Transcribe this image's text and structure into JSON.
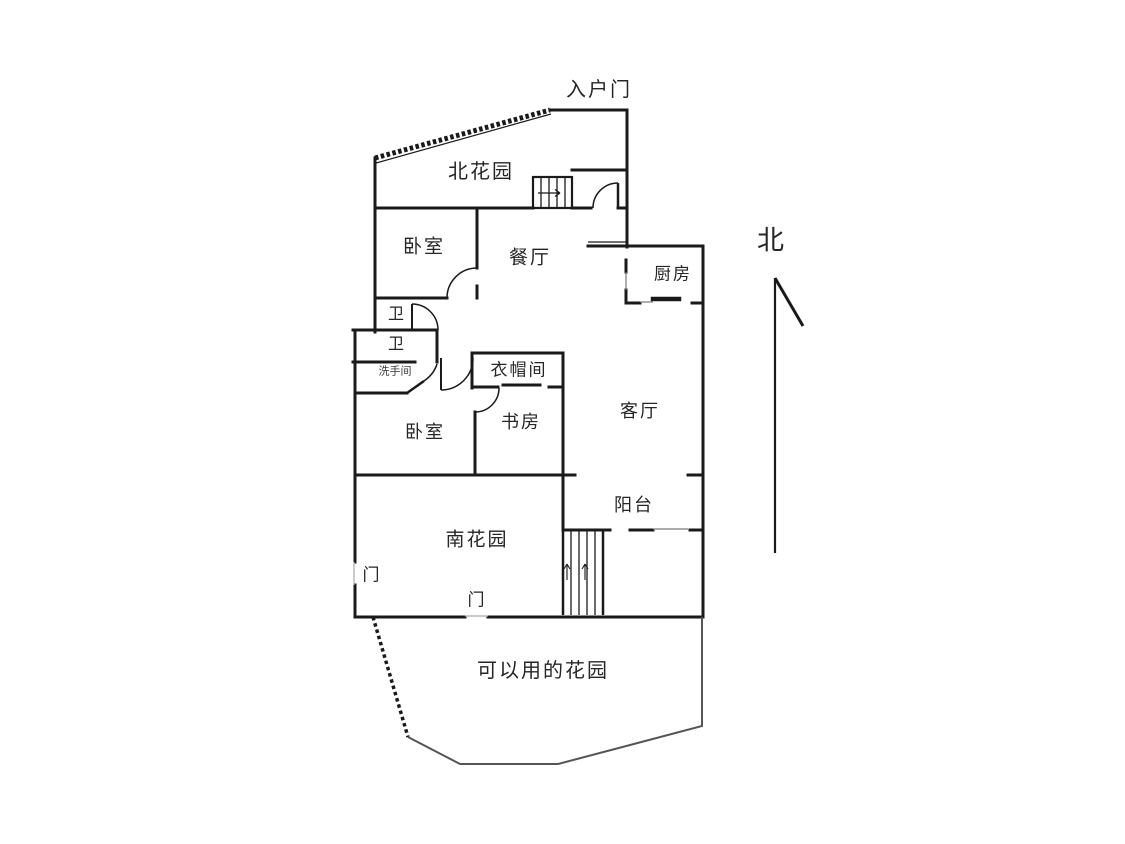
{
  "page": {
    "type": "floor-plan",
    "background": "#ffffff",
    "ink": "#1a1a1a"
  },
  "labels": {
    "entrance_door": "入户门",
    "north_garden": "北花园",
    "bedroom_north": "卧室",
    "dining_room": "餐厅",
    "kitchen": "厨房",
    "bath_upper": "卫",
    "bath_lower": "卫",
    "washroom": "洗手间",
    "cloakroom": "衣帽间",
    "study": "书房",
    "bedroom_south": "卧室",
    "living_room": "客厅",
    "balcony": "阳台",
    "south_garden": "南花园",
    "gate_west": "门",
    "gate_south": "门",
    "usable_garden": "可以用的花园",
    "compass_north": "北"
  }
}
